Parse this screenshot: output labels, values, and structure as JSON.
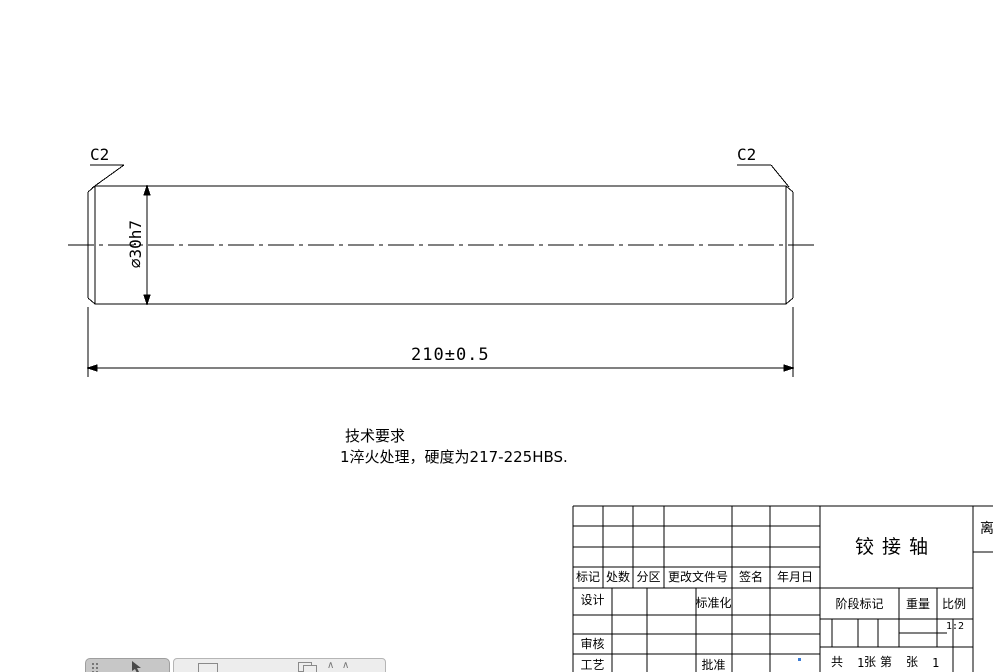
{
  "drawing": {
    "chamfer_left": "C2",
    "chamfer_right": "C2",
    "diameter": "∅30h7",
    "length": "210±0.5",
    "tech_requirements_title": "技术要求",
    "tech_requirements_line1": "1淬火处理，硬度为217-225HBS."
  },
  "title_block": {
    "revision_header": [
      "标记",
      "处数",
      "分区",
      "更改文件号",
      "签名",
      "年月日"
    ],
    "left_labels": {
      "design": "设计",
      "standard": "标准化",
      "audit": "审核",
      "craft": "工艺",
      "approve": "批准"
    },
    "part_name": "铰接轴",
    "stage_mark": "阶段标记",
    "weight": "重量",
    "scale": "比例",
    "scale_value": "1:2",
    "sheet_cells": [
      "共",
      "1",
      "张",
      "第",
      "张",
      "1"
    ],
    "clipped_right_text": "离"
  },
  "toolbar": {
    "icons": [
      "grid-handle",
      "cursor",
      "rectangle-tool",
      "window-tool",
      "chevron-up",
      "chevron-up"
    ]
  },
  "colors": {
    "line": "#000000",
    "toolbar_dark": "#c7c7c7",
    "toolbar_light": "#ededed",
    "overlay": "rgba(255,255,255,0.55)",
    "accent_dot": "#3b7bd4"
  }
}
